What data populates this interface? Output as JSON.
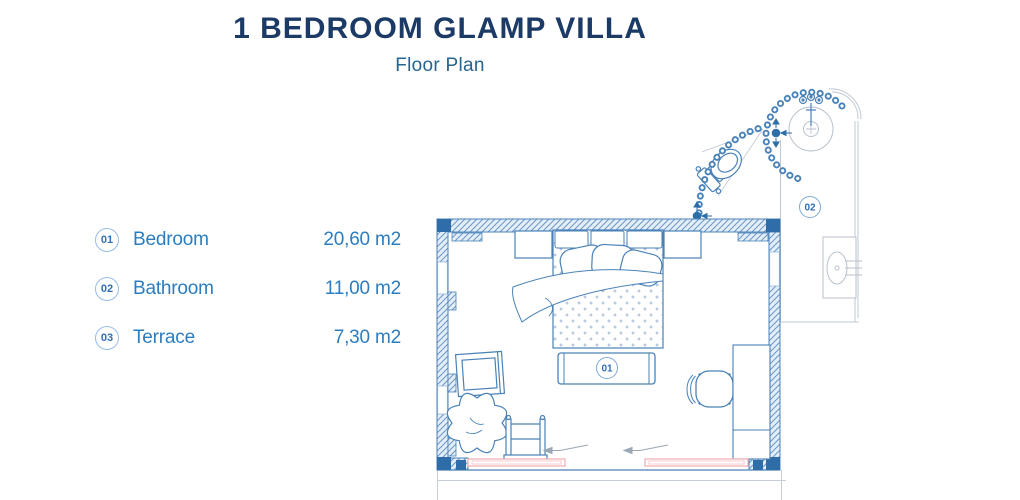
{
  "header": {
    "title": "1 BEDROOM GLAMP VILLA",
    "subtitle": "Floor Plan"
  },
  "legend": {
    "items": [
      {
        "number": "01",
        "label": "Bedroom",
        "area": "20,60 m2"
      },
      {
        "number": "02",
        "label": "Bathroom",
        "area": "11,00 m2"
      },
      {
        "number": "03",
        "label": "Terrace",
        "area": "7,30 m2"
      }
    ]
  },
  "floor_plan": {
    "room_labels": [
      {
        "number": "01",
        "room": "Bedroom"
      },
      {
        "number": "02",
        "room": "Bathroom"
      }
    ],
    "colors": {
      "title_navy": "#1c3a66",
      "subtitle_blue": "#24648f",
      "legend_blue": "#2b7dc0",
      "plan_line_blue": "#4a82b8",
      "wall_solid_blue": "#2e6da8",
      "hatch_line_blue": "#6b97c6",
      "hatch_bg": "#e4eef8",
      "door_pink": "#efaeb0",
      "light_gray": "#bfc8d2"
    }
  }
}
